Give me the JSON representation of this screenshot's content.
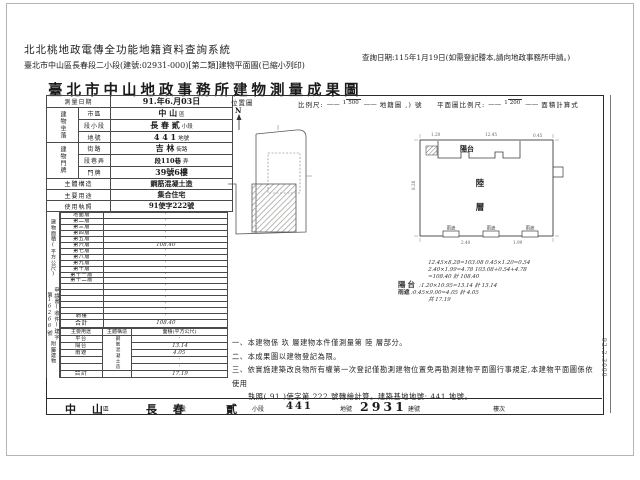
{
  "header": {
    "system_title": "北北桃地政電傳全功能地籍資料查詢系統",
    "doc_info": "臺北市中山區長春段二小段(建號:02931-000)[第二類]建物平面圖(已縮小列印)",
    "query_date": "查詢日期:115年1月19日(如需登記謄本,請向地政事務所申請。)"
  },
  "title": "臺北市中山地政事務所建物測量成果圖",
  "left": {
    "survey": {
      "label": "測量日期",
      "value": "91.年6.月03日"
    },
    "loc_group": "建物坐落",
    "addr_group": "建物門牌",
    "rows": {
      "city": {
        "label": "市區",
        "value": "中 山",
        "suffix": "區"
      },
      "section": {
        "label": "段小段",
        "value": "長 春 貳",
        "suffix": "小段"
      },
      "land": {
        "label": "地號",
        "value": "4 4 1",
        "suffix": "地號"
      },
      "street": {
        "label": "街路",
        "value": "吉 林",
        "suffix": "街路"
      },
      "lane": {
        "label": "段巷弄",
        "value": "段110巷",
        "suffix": "弄"
      },
      "door": {
        "label": "門牌",
        "value": "39號6樓",
        "suffix": ""
      }
    },
    "structure": {
      "label": "主體構造",
      "value": "鋼筋混凝土造"
    },
    "usage": {
      "label": "主要用途",
      "value": "集合住宅"
    },
    "license": {
      "label": "使用執照",
      "value": "91使字222號"
    },
    "floor_area": {
      "side_label": "建物面積(平方公尺)",
      "rows": [
        {
          "label": "地面層",
          "value": "·"
        },
        {
          "label": "第二層",
          "value": "·"
        },
        {
          "label": "第三層",
          "value": "·"
        },
        {
          "label": "第四層",
          "value": "·"
        },
        {
          "label": "第五層",
          "value": "·"
        },
        {
          "label": "第六層",
          "value": "108.40"
        },
        {
          "label": "第七層",
          "value": "·"
        },
        {
          "label": "第八層",
          "value": "·"
        },
        {
          "label": "第九層",
          "value": "·"
        },
        {
          "label": "第十層",
          "value": "·"
        },
        {
          "label": "第十一層",
          "value": "·"
        },
        {
          "label": "第十二層",
          "value": "·"
        },
        {
          "label": "",
          "value": "·"
        },
        {
          "label": "",
          "value": "·"
        },
        {
          "label": "",
          "value": "·"
        },
        {
          "label": "",
          "value": "·"
        },
        {
          "label": "",
          "value": "·"
        },
        {
          "label": "騎樓",
          "value": "·"
        }
      ],
      "total": {
        "label": "合計",
        "value": "108.40"
      }
    },
    "application": {
      "text": "申請書(收件)建字第",
      "number": "16266",
      "suffix": "號"
    },
    "attached": {
      "side_label": "附屬建物",
      "headers": [
        "主要用途",
        "主體構造",
        "面積(平方公尺)"
      ],
      "structure": "鋼筋混凝土造",
      "rows": [
        {
          "use": "平台",
          "area": "·"
        },
        {
          "use": "陽台",
          "area": "13.14"
        },
        {
          "use": "雨遮",
          "area": "4.05"
        },
        {
          "use": "",
          "area": "·"
        },
        {
          "use": "",
          "area": "·"
        }
      ],
      "total": {
        "label": "合計",
        "area": "17.19"
      }
    }
  },
  "map": {
    "loc_label": "位置圖",
    "north": "N",
    "scale1": {
      "prefix": "比例尺:",
      "num": "1",
      "den": "500",
      "suffix": "地籍圖 ,) 號"
    },
    "scale2": {
      "prefix": "平面圖比例尺:",
      "num": "1",
      "den": "200",
      "suffix": "面積計算式"
    }
  },
  "plan": {
    "balcony": "陽台",
    "floor_char1": "陸",
    "floor_char2": "層",
    "canopy": "雨遮",
    "dims": [
      "1.20",
      "12.45",
      "0.45",
      "8.28",
      "2.40",
      "1.99"
    ]
  },
  "calc": {
    "line1": "12.45×8.28=103.08  0.45×1.20=0.54",
    "line2": "2.40×1.99=4.78  103.08+0.54+4.78",
    "line3": "=108.40  計 108.40",
    "balcony_label": "陽台",
    "balcony_text": ":1.20×10.95=13.14  計 13.14",
    "canopy_label": "雨遮",
    "canopy_text": ":0.45×9.00=4.05  計 4.05",
    "canopy_text2": "共 17.19"
  },
  "notes": {
    "n1": "一、本建物係 玖 層建物本件僅測量第 陸 層部分。",
    "n2": "二、本成果圖以建物登記為限。",
    "n3": "三、依實施建築改良物所有權第一次登記僅勘測建物位置免再勘測建物平面圖行事規定,本建物平面圖係依使用",
    "n4": "執照( 91 )使字第 222 號轉繪計算。建築基地地號: 441 地號。"
  },
  "side_code": "92.2.3000",
  "footer": {
    "items": [
      {
        "value": "中 山",
        "label": "區"
      },
      {
        "value": "長 春",
        "label": "段"
      },
      {
        "value": "貳",
        "label": "小段"
      },
      {
        "value": "441",
        "label": "地號"
      },
      {
        "value": "2931",
        "label": "建號"
      },
      {
        "value": "",
        "label": "樓次"
      }
    ]
  }
}
